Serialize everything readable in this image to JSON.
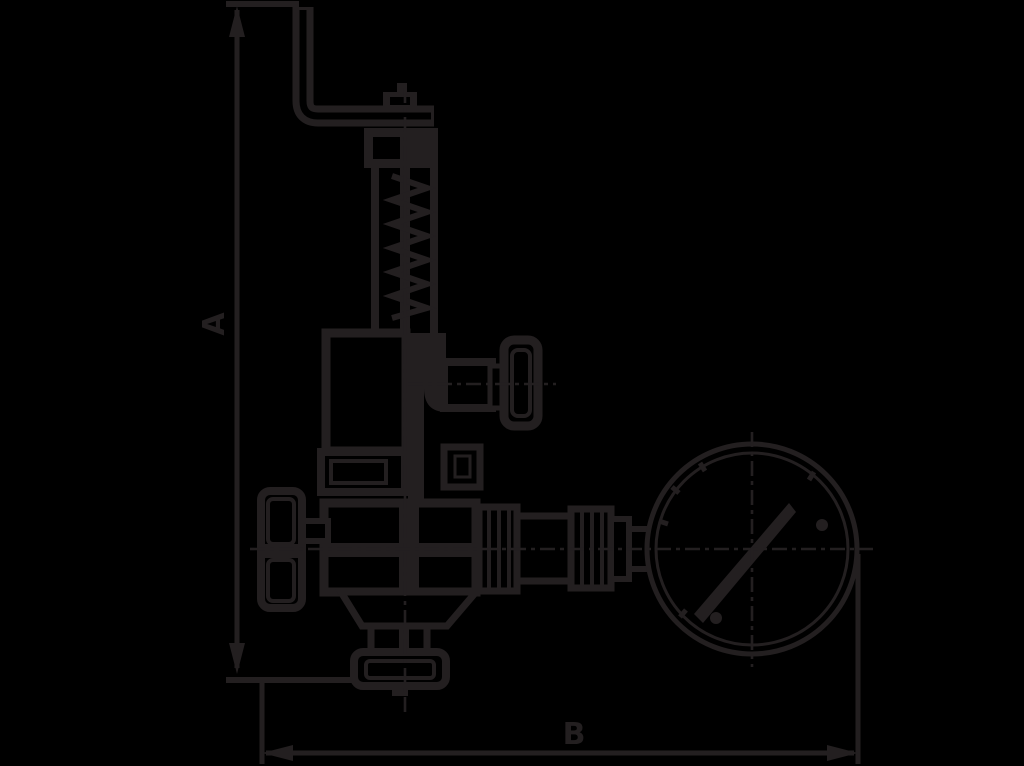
{
  "page": {
    "title": "Safety relief valve with pressure gauge - dimensional drawing",
    "background_color": "#000000",
    "line_color": "#231f20"
  },
  "dimensions": {
    "vertical": {
      "label": "A"
    },
    "horizontal": {
      "label": "B"
    }
  },
  "components": [
    "lever-arm",
    "top-nut",
    "spring-bonnet",
    "spring-coil",
    "test-knob",
    "mid-flange",
    "valve-body",
    "handwheel",
    "bottom-flange",
    "union-nuts",
    "gauge-stem",
    "pressure-gauge",
    "gauge-needle"
  ]
}
